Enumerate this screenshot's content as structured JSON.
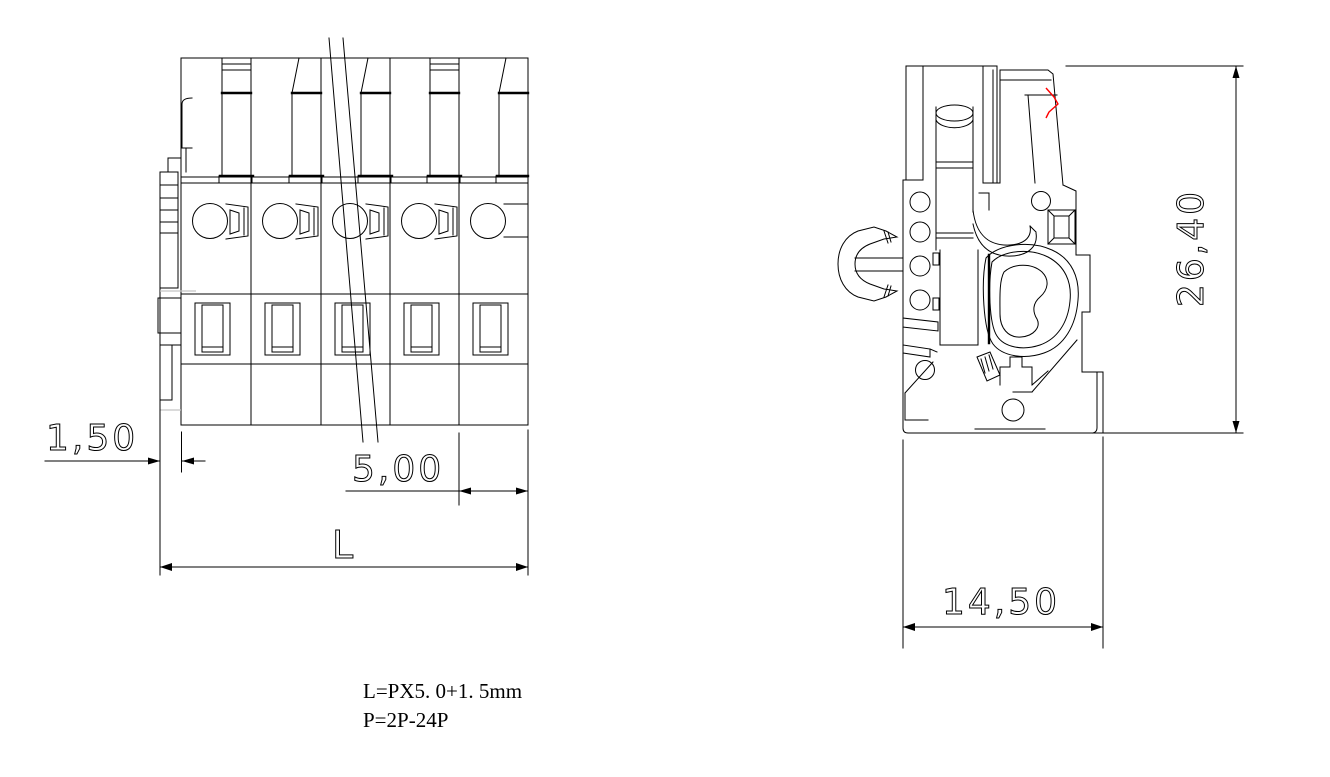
{
  "drawing": {
    "background": "#ffffff",
    "line_color": "#000000",
    "accent_color": "#ff0000",
    "dimensions": {
      "end_margin": "1,50",
      "pitch": "5,00",
      "total_length": "L",
      "height": "26,40",
      "depth": "14,50"
    },
    "notes": {
      "formula": "L=PX5. 0+1. 5mm",
      "range": "P=2P-24P"
    }
  }
}
